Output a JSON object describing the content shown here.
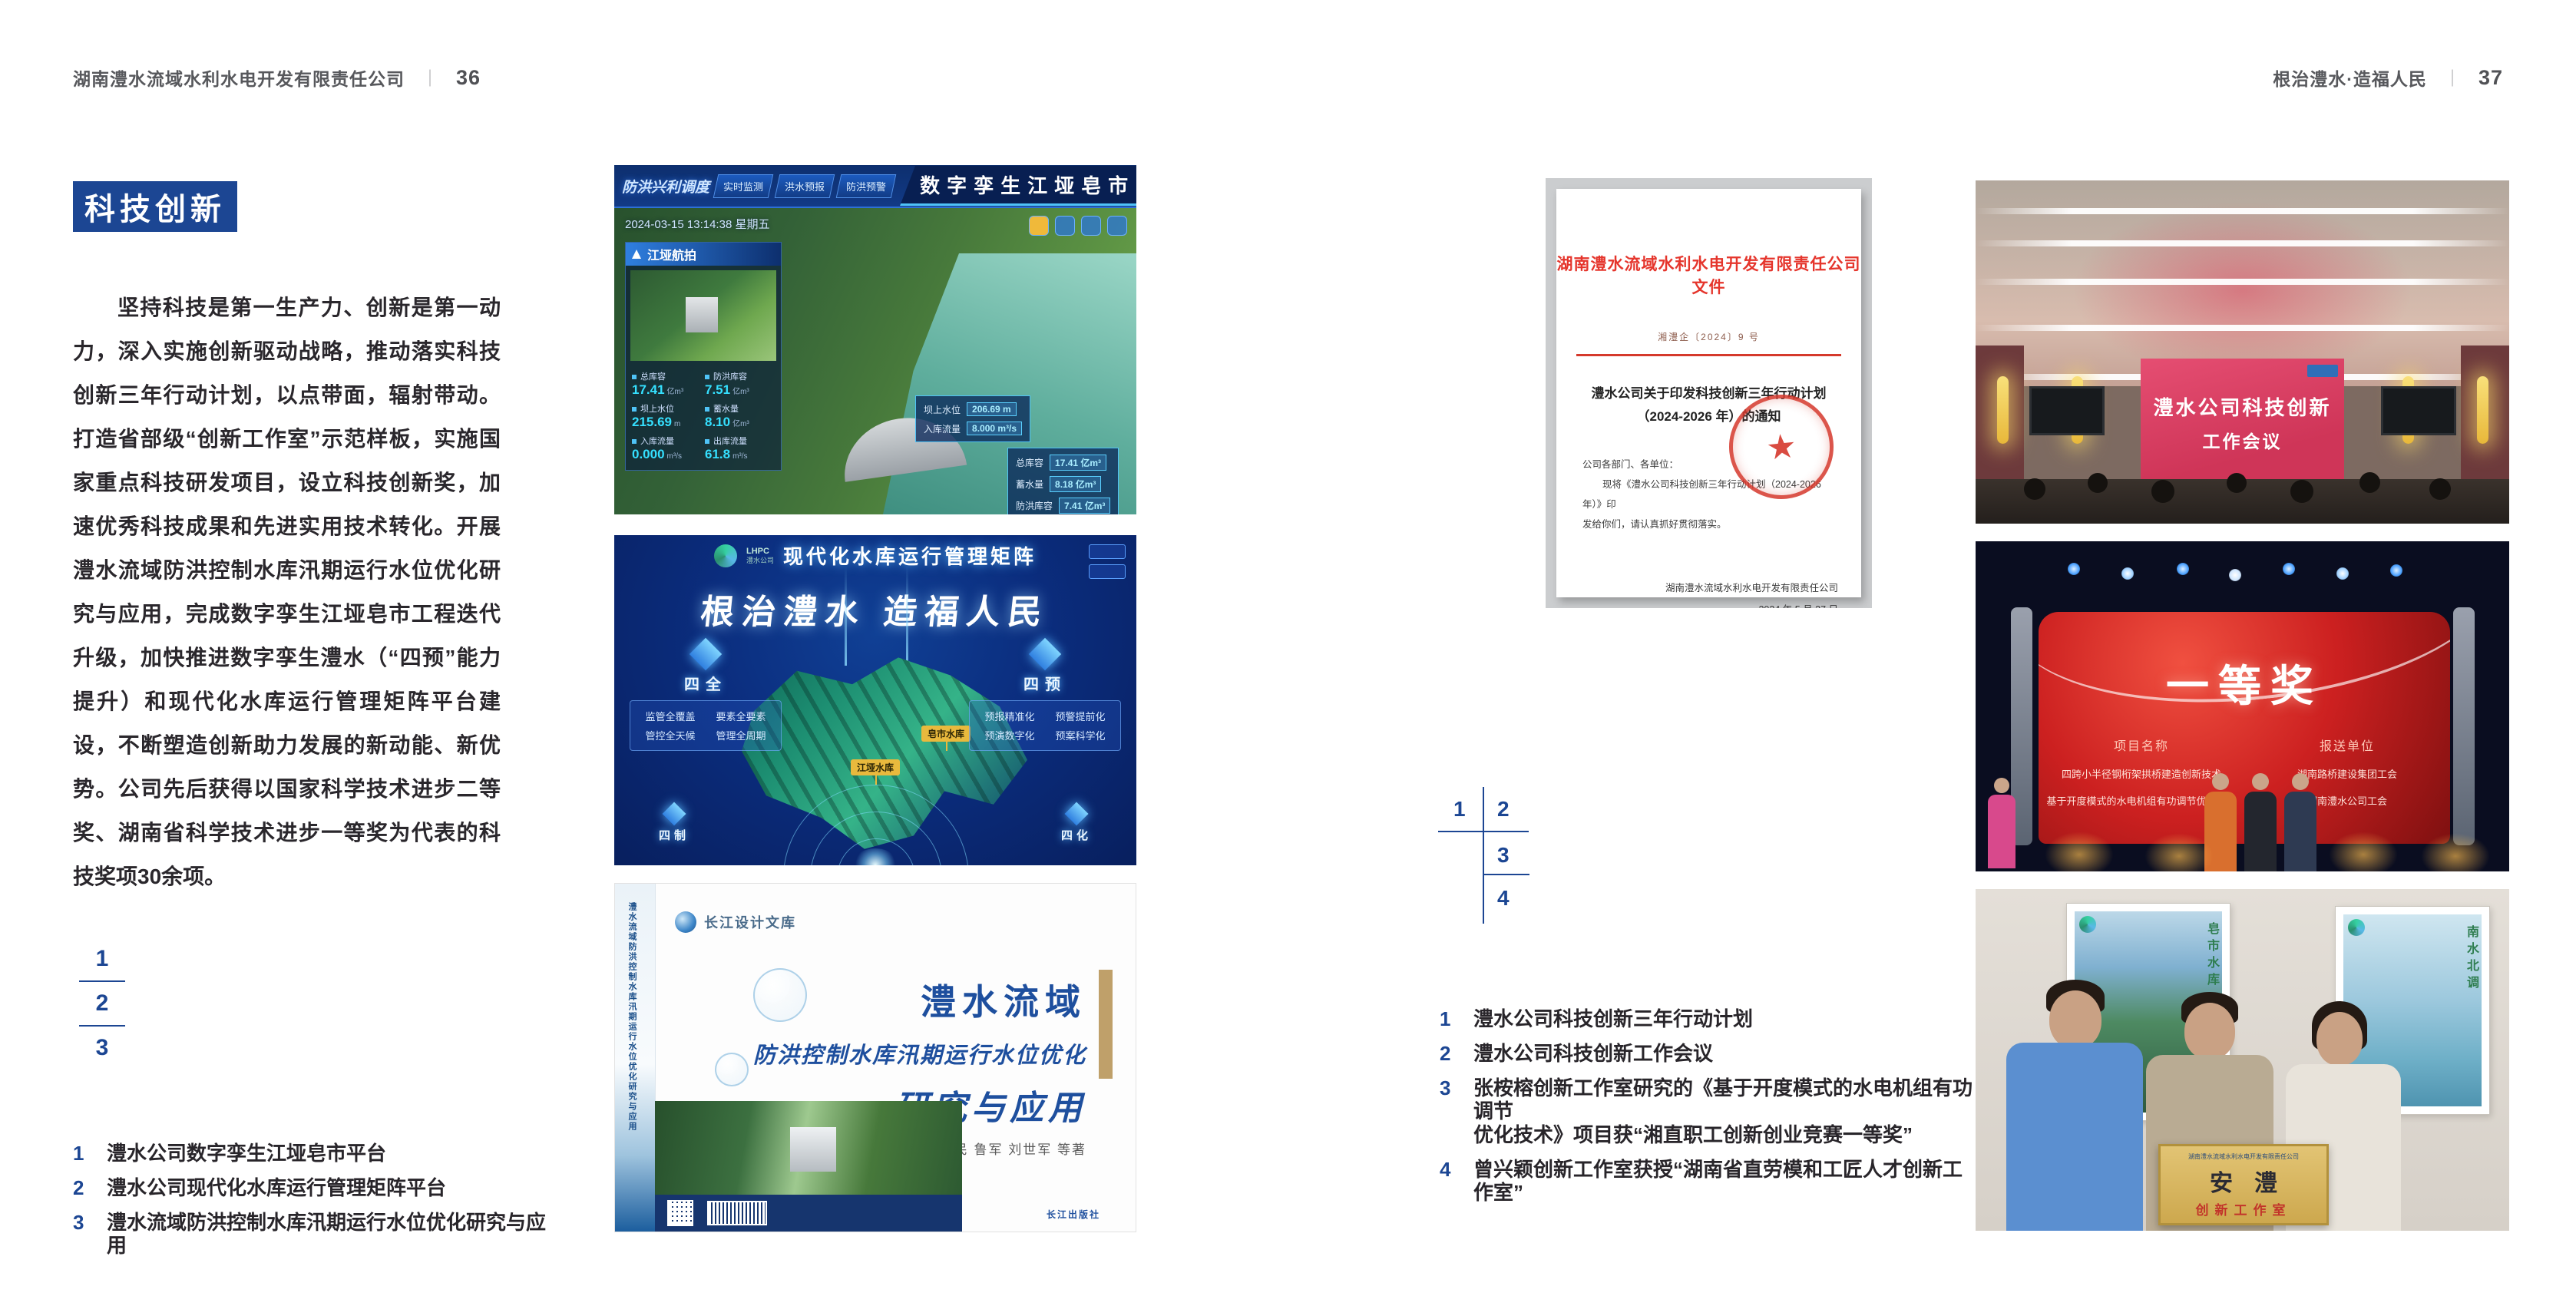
{
  "colors": {
    "accent_blue": "#1c4693",
    "header_gray": "#57585c",
    "doc_red": "#e5352c",
    "gold": "#d9b85f"
  },
  "left_page": {
    "header": {
      "company": "湖南澧水流域水利水电开发有限责任公司",
      "separator": "｜",
      "page_number": "36"
    },
    "section_title": "科技创新",
    "paragraph": "坚持科技是第一生产力、创新是第一动力，深入实施创新驱动战略，推动落实科技创新三年行动计划，以点带面，辐射带动。打造省部级“创新工作室”示范样板，实施国家重点科技研发项目，设立科技创新奖，加速优秀科技成果和先进实用技术转化。开展澧水流域防洪控制水库汛期运行水位优化研究与应用，完成数字孪生江垭皂市工程迭代升级，加快推进数字孪生澧水（“四预”能力提升）和现代化水库运行管理矩阵平台建设，不断塑造创新助力发展的新动能、新优势。公司先后获得以国家科学技术进步二等奖、湖南省科学技术进步一等奖为代表的科技奖项30余项。",
    "figure_index": {
      "n1": "1",
      "n2": "2",
      "n3": "3"
    },
    "captions": [
      {
        "num": "1",
        "text": "澧水公司数字孪生江垭皂市平台"
      },
      {
        "num": "2",
        "text": "澧水公司现代化水库运行管理矩阵平台"
      },
      {
        "num": "3",
        "text": "澧水流域防洪控制水库汛期运行水位优化研究与应用"
      }
    ],
    "dashboard": {
      "title": "数字孪生江垭皂市",
      "corner_label": "防洪兴利调度",
      "tabs_left": {
        "t1": "实时监测",
        "t2": "洪水预报",
        "t3": "防洪预警"
      },
      "tabs_right": {
        "t1": "精细预演",
        "t2": "预案生成",
        "t3": "调度执行",
        "t4": "工程复盘"
      },
      "timestamp": "2024-03-15 13:14:38 星期五",
      "panel_title": "江垭航拍",
      "stats": [
        {
          "label": "总库容",
          "value": "17.41",
          "unit": "亿m³"
        },
        {
          "label": "防洪库容",
          "value": "7.51",
          "unit": "亿m³"
        },
        {
          "label": "坝上水位",
          "value": "215.69",
          "unit": "m"
        },
        {
          "label": "蓄水量",
          "value": "8.10",
          "unit": "亿m³"
        },
        {
          "label": "入库流量",
          "value": "0.000",
          "unit": "m³/s"
        },
        {
          "label": "出库流量",
          "value": "61.8",
          "unit": "m³/s"
        }
      ],
      "overlay1": [
        {
          "label": "坝上水位",
          "value": "206.69 m"
        },
        {
          "label": "入库流量",
          "value": "8.000 m³/s"
        }
      ],
      "overlay2": [
        {
          "label": "总库容",
          "value": "17.41 亿m³"
        },
        {
          "label": "蓄水量",
          "value": "8.18 亿m³"
        },
        {
          "label": "防洪库容",
          "value": "7.41 亿m³"
        }
      ]
    },
    "matrix": {
      "logo_line1": "LHPC",
      "logo_line2": "澧水公司",
      "title": "现代化水库运行管理矩阵",
      "slogan": "根治澧水 造福人民",
      "panel_left": {
        "title": "四全",
        "items": [
          "监管全覆盖",
          "要素全要素",
          "管控全天候",
          "管理全周期"
        ]
      },
      "panel_right": {
        "title": "四预",
        "items": [
          "预报精准化",
          "预警提前化",
          "预演数字化",
          "预案科学化"
        ]
      },
      "panel_bottom_left": "四制",
      "panel_bottom_right": "四化",
      "map_labels": {
        "l1": "皂市水库",
        "l2": "江垭水库"
      }
    },
    "book": {
      "series": "长江设计文库",
      "spine": "澧水流域防洪控制水库汛期运行水位优化研究与应用",
      "title_line1": "澧水流域",
      "title_line2": "防洪控制水库汛期运行水位优化",
      "title_line3": "研究与应用",
      "authors": "洪兴骏 沈坤民 鲁军 刘世军 等著",
      "publisher": "长江出版社"
    }
  },
  "right_page": {
    "header": {
      "slogan": "根治澧水·造福人民",
      "separator": "｜",
      "page_number": "37"
    },
    "document": {
      "title": "湖南澧水流域水利水电开发有限责任公司文件",
      "doc_number": "湘澧企〔2024〕9 号",
      "subject_line1": "澧水公司关于印发科技创新三年行动计划",
      "subject_line2": "（2024-2026 年）的通知",
      "salutation": "公司各部门、各单位：",
      "body_line1": "现将《澧水公司科技创新三年行动计划（2024-2026 年）》印",
      "body_line2": "发给你们，请认真抓好贯彻落实。",
      "signature": "湖南澧水流域水利水电开发有限责任公司",
      "date": "2024 年 5 月 27 日",
      "star": "★"
    },
    "figure_index": {
      "n1": "1",
      "n2": "2",
      "n3": "3",
      "n4": "4"
    },
    "captions": [
      {
        "num": "1",
        "line1": "澧水公司科技创新三年行动计划",
        "line2": ""
      },
      {
        "num": "2",
        "line1": "澧水公司科技创新工作会议",
        "line2": ""
      },
      {
        "num": "3",
        "line1": "张桉榕创新工作室研究的《基于开度模式的水电机组有功调节",
        "line2": "优化技术》项目获“湘直职工创新创业竞赛一等奖”"
      },
      {
        "num": "4",
        "line1": "曾兴颖创新工作室获授“湖南省直劳模和工匠人才创新工作室”",
        "line2": ""
      }
    ],
    "meeting": {
      "screen_line1": "澧水公司科技创新",
      "screen_line2": "工作会议"
    },
    "award": {
      "title": "一等奖",
      "col_left": "项目名称",
      "col_right": "报送单位",
      "rows": [
        {
          "project": "四跨小半径钢桁架拱桥建造创新技术",
          "org": "湖南路桥建设集团工会"
        },
        {
          "project": "基于开度模式的水电机组有功调节优化技术",
          "org": "湖南澧水公司工会"
        }
      ]
    },
    "plaque": {
      "org": "湖南澧水流域水利水电开发有限责任公司",
      "name": "安澧",
      "label": "创新工作室",
      "poster_left_caption": "皂市水库",
      "poster_right_caption": "南水北调"
    }
  }
}
